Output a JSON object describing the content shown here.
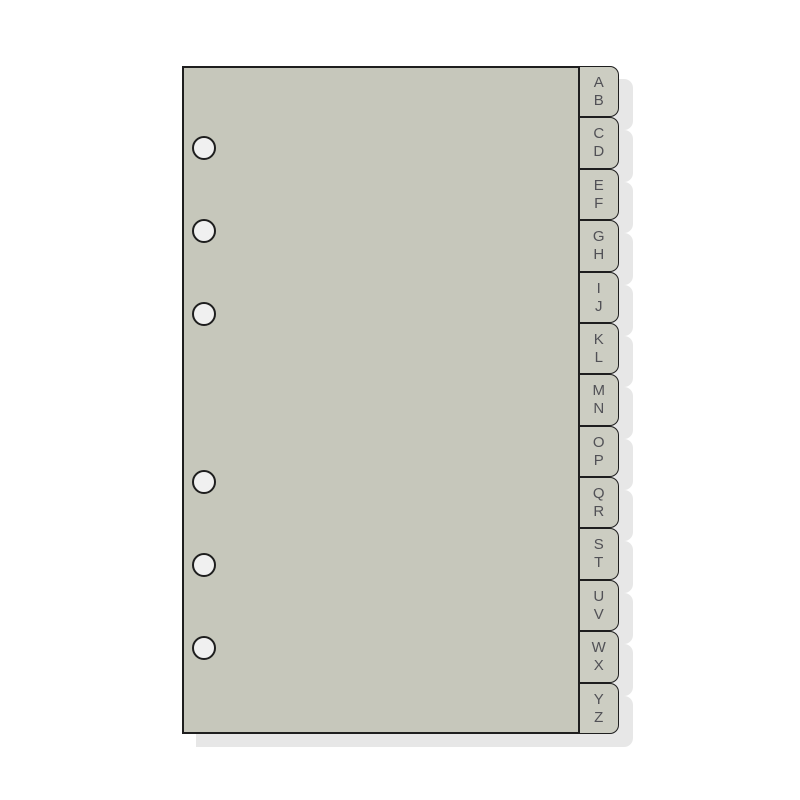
{
  "tabs": [
    {
      "top": "A",
      "bottom": "B"
    },
    {
      "top": "C",
      "bottom": "D"
    },
    {
      "top": "E",
      "bottom": "F"
    },
    {
      "top": "G",
      "bottom": "H"
    },
    {
      "top": "I",
      "bottom": "J"
    },
    {
      "top": "K",
      "bottom": "L"
    },
    {
      "top": "M",
      "bottom": "N"
    },
    {
      "top": "O",
      "bottom": "P"
    },
    {
      "top": "Q",
      "bottom": "R"
    },
    {
      "top": "S",
      "bottom": "T"
    },
    {
      "top": "U",
      "bottom": "V"
    },
    {
      "top": "W",
      "bottom": "X"
    },
    {
      "top": "Y",
      "bottom": "Z"
    }
  ],
  "punch_holes": {
    "count": 6
  },
  "colors": {
    "background": "#ffffff",
    "page": "#c6c7bb",
    "tab": "#cccdc2",
    "outline": "#1e1e1e",
    "shadow": "#e7e7e7",
    "hole": "#f0f0f0",
    "letter": "#515156"
  }
}
